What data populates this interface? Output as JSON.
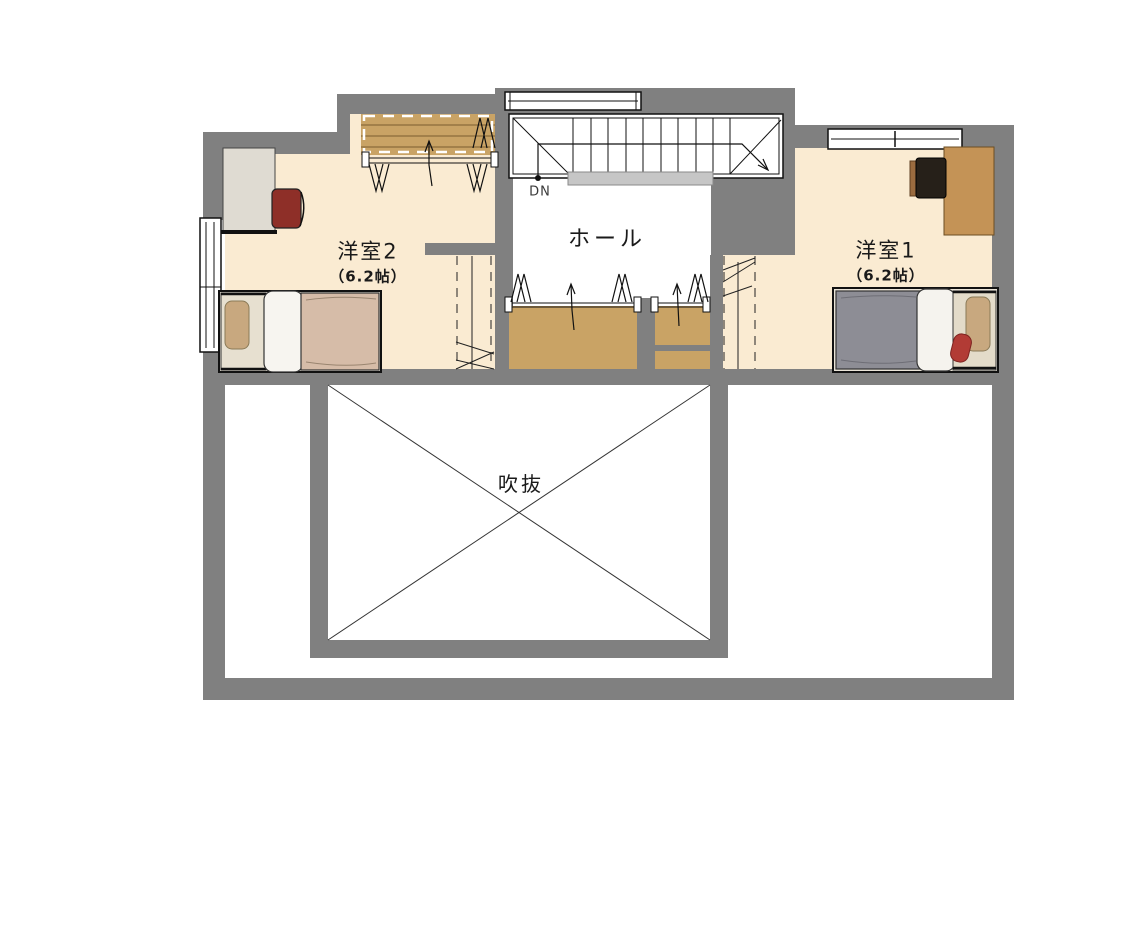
{
  "plan": {
    "type": "residential-floor-plan-2F",
    "rooms": [
      {
        "id": "yoshitsu2",
        "name": "洋室2",
        "size": "（6.2帖）"
      },
      {
        "id": "yoshitsu1",
        "name": "洋室1",
        "size": "（6.2帖）"
      },
      {
        "id": "hall",
        "name": "ホール"
      },
      {
        "id": "void",
        "name": "吹抜"
      }
    ],
    "stairs": {
      "direction_label": "DN"
    },
    "icons": [
      "hanger-icon",
      "open-direction-arrow-icon",
      "window-icon",
      "void-x-icon",
      "down-walkline-icon"
    ],
    "palette": {
      "wall_gray": "#808080",
      "floor_cream": "#FAEBD2",
      "closet_wood": "#C9A365",
      "shelf_line": "#7a5c2e",
      "handrail_gray": "#C6C6C6",
      "line_black": "#111111",
      "bed_blanket_gray": "#8D8D95",
      "bed_blanket_beige": "#D6BCA8",
      "pillow_tan": "#C8A87F",
      "pillow_white": "#F6F4EF",
      "chair_red": "#8E2F28",
      "cushion_red": "#B23B35",
      "desk_wood": "#C49356",
      "desk_light": "#DFDBD2",
      "chair_dark": "#262019"
    }
  }
}
